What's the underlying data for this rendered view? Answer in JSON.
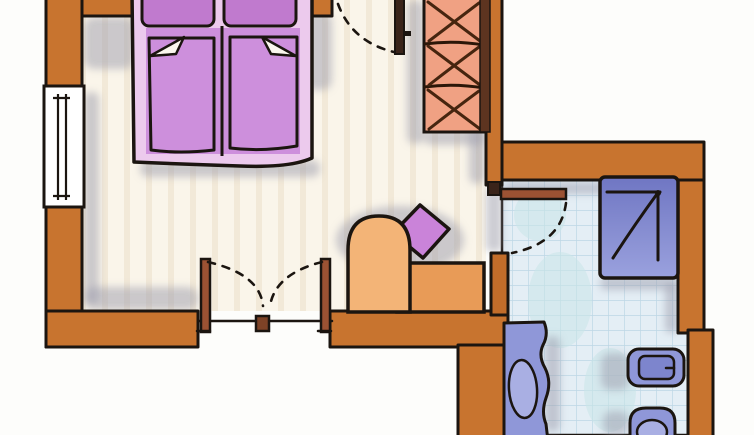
{
  "canvas": {
    "width": 754,
    "height": 435
  },
  "title": "Hand-drawn hotel room floor plan (bedroom with en-suite bathroom)",
  "rooms": [
    {
      "name": "bedroom",
      "floor": "light wood planks, cream"
    },
    {
      "name": "bathroom",
      "floor": "light blue tiles with grid"
    }
  ],
  "fixtures": [
    {
      "name": "double-bed",
      "parts": [
        "pillow-left",
        "pillow-right",
        "duvet-left",
        "duvet-right",
        "fold-left",
        "fold-right"
      ]
    },
    {
      "name": "wardrobe",
      "symbol": "three stacked X cells"
    },
    {
      "name": "window",
      "location": "left wall"
    },
    {
      "name": "entry-door",
      "location": "top wall",
      "swing": "dashed arc into bedroom"
    },
    {
      "name": "balcony-double-door",
      "location": "bottom wall",
      "swing": "two dashed arcs meeting at center"
    },
    {
      "name": "bathroom-door",
      "location": "bedroom-bathroom wall",
      "swing": "dashed arc into bathroom"
    },
    {
      "name": "armchair",
      "parts": [
        "rounded-back",
        "bench-seat",
        "purple-cushion"
      ]
    },
    {
      "name": "shower",
      "symbol": "square with diagonal"
    },
    {
      "name": "sink",
      "symbol": "wavy counter with oval basin"
    },
    {
      "name": "bidet"
    },
    {
      "name": "toilet"
    }
  ],
  "palette": {
    "wall_orange": "#c8742f",
    "wardrobe_salmon": "#f0a183",
    "wardrobe_x_brown": "#46250f",
    "bed_border_lavender": "#eccaed",
    "duvet_purple": "#cd8fdc",
    "pillow_purple": "#c07ace",
    "cushion_purple": "#ca83d9",
    "chair_light_orange": "#f3b477",
    "seat_orange": "#e89b57",
    "door_wood_brown": "#9c5233",
    "bath_fixture_blue": "#8f97d8",
    "shower_blue_violet": "#858cd0",
    "bath_floor_blue": "#e4eef5",
    "bath_grid_blue": "#bdd7e5",
    "bedroom_floor_cream": "#faf5ea",
    "plank_stripe": "#efe5d1",
    "shadow_gray": "#9b9cab",
    "outline_ink": "#1b1510",
    "background_white": "#fdfdfb"
  }
}
